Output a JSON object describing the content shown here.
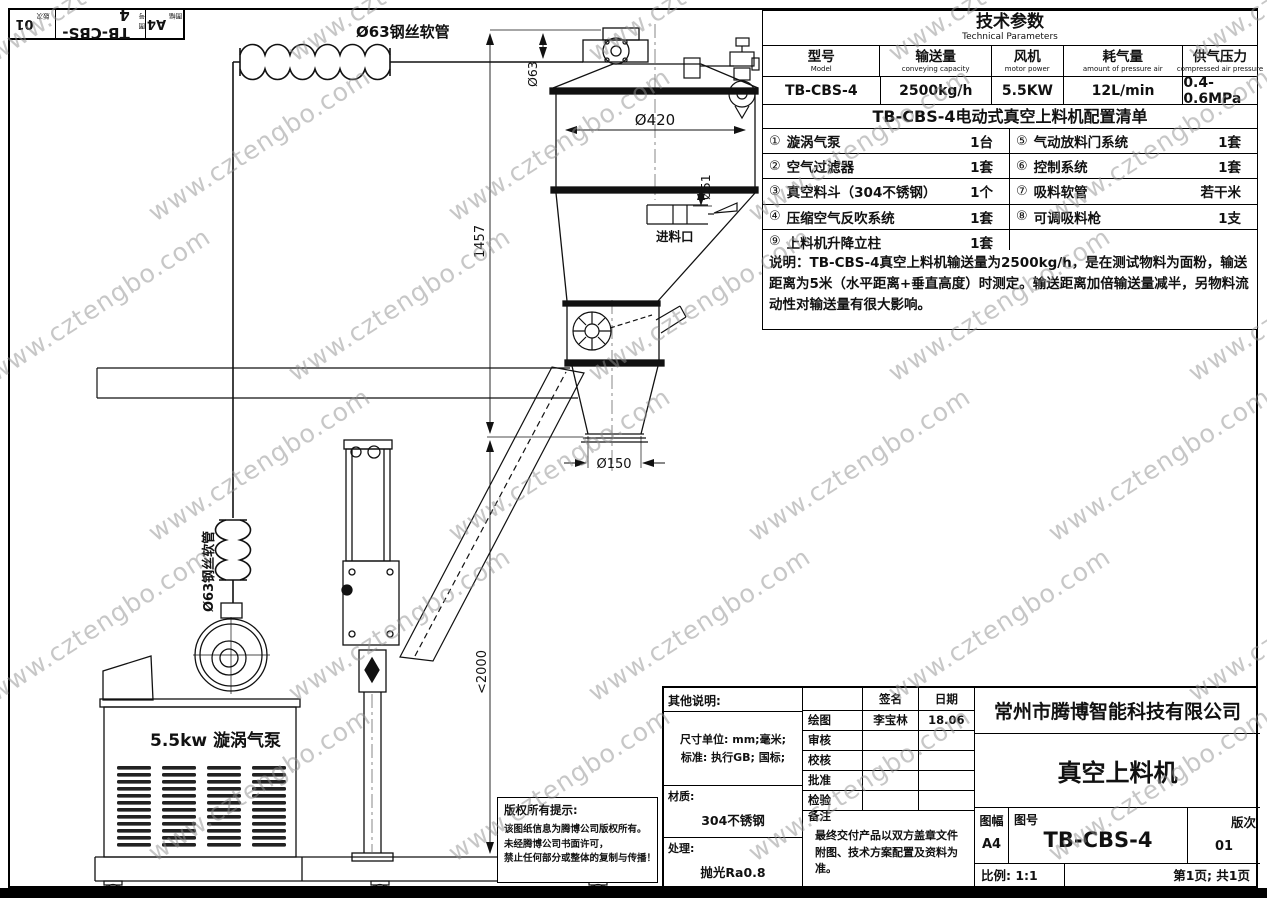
{
  "watermark": {
    "text": "www.cztengbo.com",
    "color": "#909090"
  },
  "corner_block": {
    "sheet_label": "图幅",
    "sheet": "A4",
    "number_label": "图号",
    "number": "TB-CBS-4",
    "rev_label": "版次",
    "rev": "01"
  },
  "tech_params": {
    "title": "技术参数",
    "subtitle": "Technical Parameters",
    "columns": [
      {
        "cn": "型号",
        "en": "Model"
      },
      {
        "cn": "输送量",
        "en": "conveying capacity"
      },
      {
        "cn": "风机",
        "en": "motor power"
      },
      {
        "cn": "耗气量",
        "en": "amount of pressure air"
      },
      {
        "cn": "供气压力",
        "en": "compressed air pressure"
      }
    ],
    "values": [
      "TB-CBS-4",
      "2500kg/h",
      "5.5KW",
      "12L/min",
      "0.4-0.6MPa"
    ]
  },
  "config_list": {
    "title": "TB-CBS-4电动式真空上料机配置清单",
    "items_left": [
      {
        "no": "①",
        "name": "漩涡气泵",
        "qty": "1台"
      },
      {
        "no": "②",
        "name": "空气过滤器",
        "qty": "1套"
      },
      {
        "no": "③",
        "name": "真空料斗（304不锈钢）",
        "qty": "1个"
      },
      {
        "no": "④",
        "name": "压缩空气反吹系统",
        "qty": "1套"
      },
      {
        "no": "⑨",
        "name": "上料机升降立柱",
        "qty": "1套"
      }
    ],
    "items_right": [
      {
        "no": "⑤",
        "name": "气动放料门系统",
        "qty": "1套"
      },
      {
        "no": "⑥",
        "name": "控制系统",
        "qty": "1套"
      },
      {
        "no": "⑦",
        "name": "吸料软管",
        "qty": "若干米"
      },
      {
        "no": "⑧",
        "name": "可调吸料枪",
        "qty": "1支"
      },
      {
        "no": "",
        "name": "",
        "qty": ""
      }
    ]
  },
  "note": "说明：TB-CBS-4真空上料机输送量为2500kg/h，是在测试物料为面粉，输送距离为5米（水平距离+垂直高度）时测定。输送距离加倍输送量减半，另物料流动性对输送量有很大影响。",
  "drawing": {
    "hose_top": "Ø63钢丝软管",
    "hose_left": "Ø63钢丝软管",
    "dim_63": "Ø63",
    "dim_420": "Ø420",
    "dim_51": "Ø51",
    "dim_150": "Ø150",
    "dim_1457": "1457",
    "dim_2000": "<2000",
    "inlet": "进料口",
    "pump": "5.5kw 漩涡气泵"
  },
  "title_block": {
    "copyright": {
      "title": "版权所有提示:",
      "line1": "该图纸信息为腾博公司版权所有。",
      "line2": "未经腾博公司书面许可，",
      "line3": "禁止任何部分或整体的复制与传播！"
    },
    "other_notes_label": "其他说明:",
    "units_line1": "尺寸单位: mm;毫米;",
    "units_line2": "标准: 执行GB; 国标;",
    "material_label": "材质:",
    "material": "304不锈钢",
    "finish_label": "处理:",
    "finish": "抛光Ra0.8",
    "sign_header": {
      "sign": "签名",
      "date": "日期"
    },
    "rows": [
      {
        "label": "绘图",
        "sign": "李宝林",
        "date": "18.06"
      },
      {
        "label": "审核",
        "sign": "",
        "date": ""
      },
      {
        "label": "校核",
        "sign": "",
        "date": ""
      },
      {
        "label": "批准",
        "sign": "",
        "date": ""
      },
      {
        "label": "检验",
        "sign": "",
        "date": ""
      }
    ],
    "remark_label": "备注",
    "remark": "最终交付产品以双方盖章文件附图、技术方案配置及资料为准。",
    "company": "常州市腾博智能科技有限公司",
    "product": "真空上料机",
    "sheet_label": "图幅",
    "sheet": "A4",
    "number_label": "图号",
    "number": "TB-CBS-4",
    "rev_label": "版次",
    "rev": "01",
    "scale": "比例: 1:1",
    "page": "第1页; 共1页"
  }
}
